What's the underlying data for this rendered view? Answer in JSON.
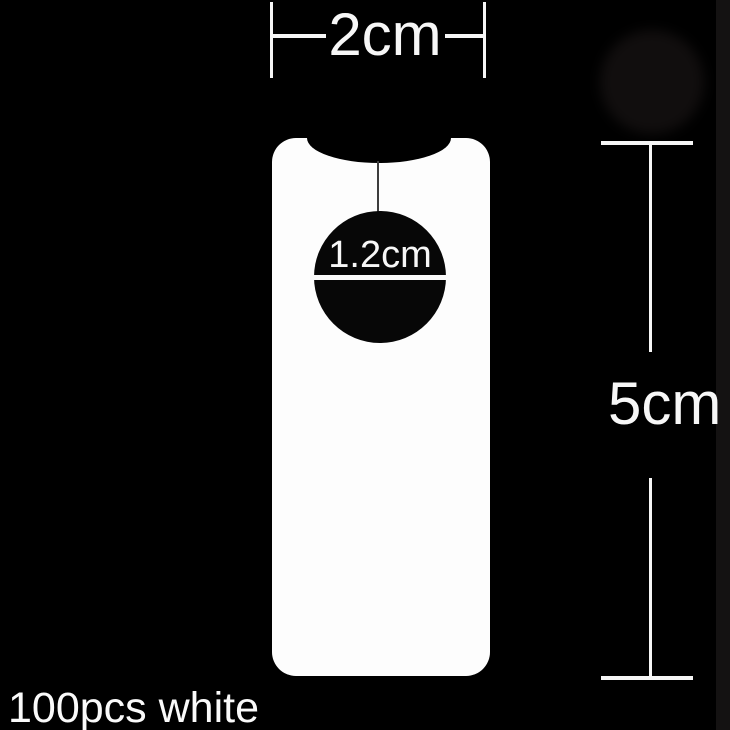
{
  "scene": {
    "background_color": "#000000",
    "caption": "100pcs white"
  },
  "tag": {
    "fill_color": "#fdfdfd",
    "hole_color": "#070707",
    "string_color": "#3d3d3d"
  },
  "measurements": {
    "width": {
      "label": "2cm"
    },
    "height": {
      "label": "5cm"
    },
    "hole_diameter": {
      "label": "1.2cm"
    }
  }
}
